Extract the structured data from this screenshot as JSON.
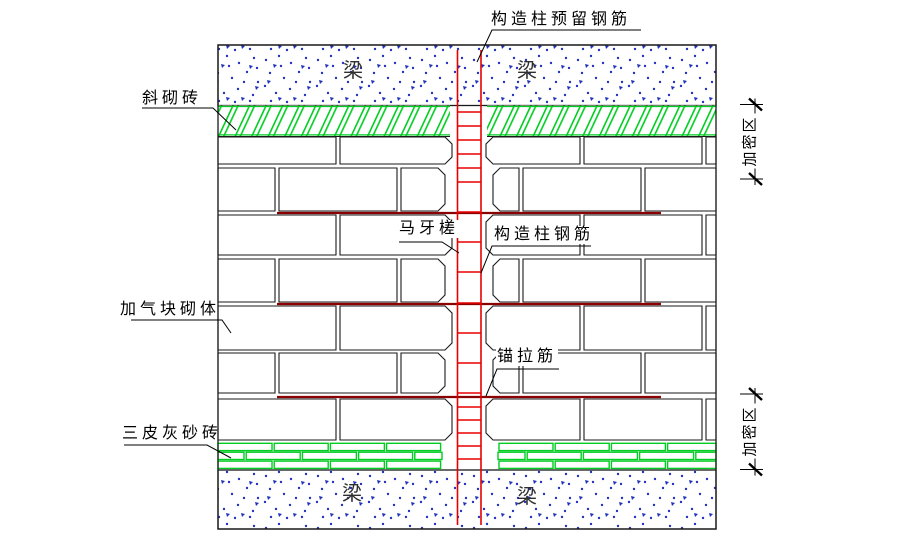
{
  "labels": {
    "top_rebar": "构造柱预留钢筋",
    "diagonal_brick": "斜砌砖",
    "aerated_block": "加气块砌体",
    "lime_sand_brick": "三皮灰砂砖",
    "toothed_joint": "马牙槎",
    "column_rebar": "构造柱钢筋",
    "anchor_tie": "锚拉筋",
    "densified_zone_top": "加密区",
    "densified_zone_bottom": "加密区"
  },
  "beam_labels": [
    "梁",
    "梁",
    "梁",
    "梁"
  ],
  "colors": {
    "outline": "#1a1a1a",
    "green": "#00cc22",
    "rebar_red": "#e80000",
    "tie_dark_red": "#8b0000",
    "speck_blue": "#2233bb",
    "text": "#000000",
    "beam_text": "#2f2f2f",
    "background": "#ffffff"
  }
}
